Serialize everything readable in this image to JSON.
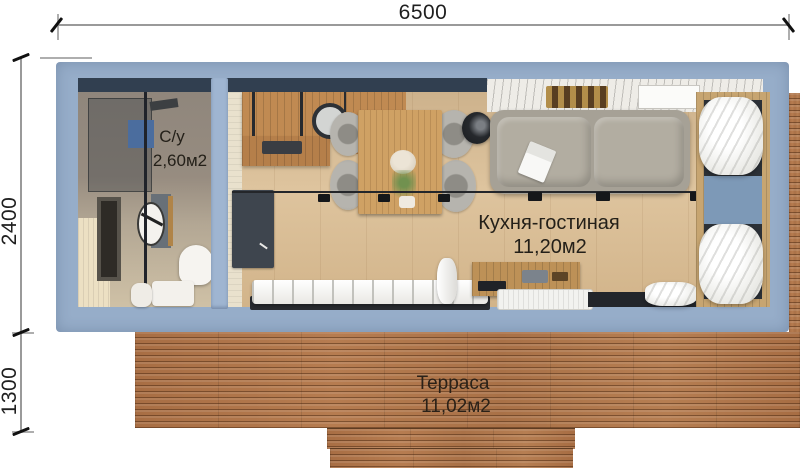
{
  "dimensions": {
    "width": "6500",
    "house_depth": "2400",
    "terrace_depth": "1300"
  },
  "rooms": {
    "bathroom": {
      "name": "С/у",
      "area": "2,60м2"
    },
    "kitchen_living": {
      "name": "Кухня-гостиная",
      "area": "11,20м2"
    },
    "terrace": {
      "name": "Терраса",
      "area": "11,02м2"
    }
  },
  "colors": {
    "wall_blue": "#96adc9",
    "partition_blue": "#9fb5d1",
    "deck_wood": "#ab7248",
    "floor_wood": "#d7bb95",
    "counter_wood": "#c08a52",
    "sofa_grey": "#a6a196",
    "dark_furniture": "#3e454e",
    "duvet_white": "#f4f3f0",
    "window_blue": "#7d99b7",
    "label_text": "#242019",
    "dim_line_grey": "#9a9a9a"
  }
}
